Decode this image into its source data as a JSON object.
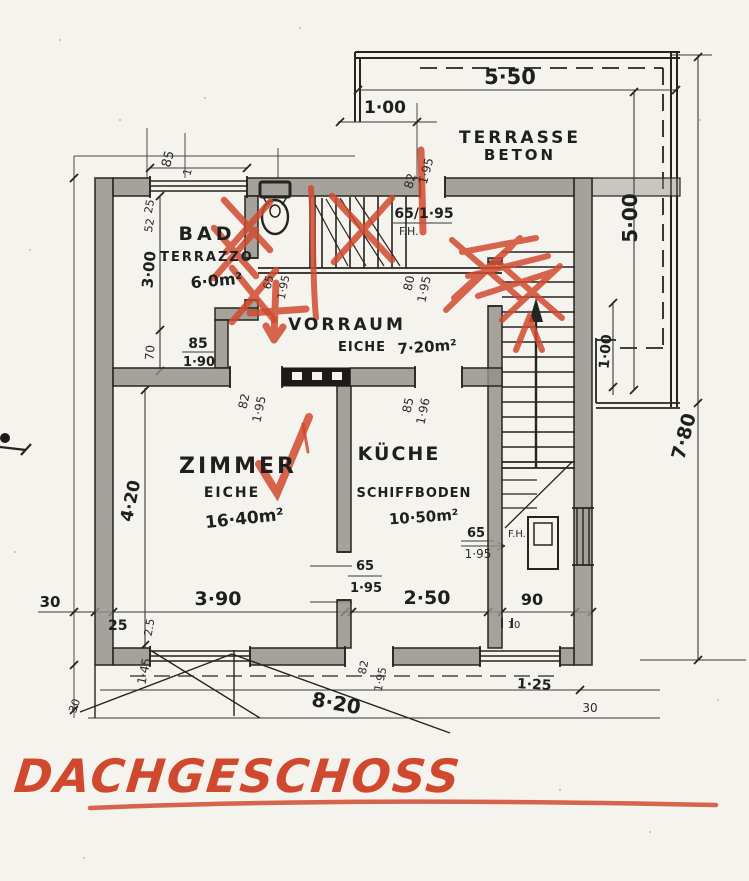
{
  "title": "DACHGESCHOSS",
  "terrace": {
    "line1": "TERRASSE",
    "line2": "BETON"
  },
  "rooms": {
    "bad": {
      "name": "BAD",
      "finish": "TERRAZZO",
      "area": "6·0m²"
    },
    "vorraum": {
      "name": "VORRAUM",
      "finish": "EICHE",
      "area": "7·20m²"
    },
    "zimmer": {
      "name": "ZIMMER",
      "finish": "EICHE",
      "area": "16·40m²"
    },
    "kueche": {
      "name": "KÜCHE",
      "finish": "SCHIFFBODEN",
      "area": "10·50m²"
    }
  },
  "dims": {
    "top_100": "1·00",
    "top_550": "5·50",
    "right_500": "5·00",
    "right_780": "7·80",
    "terrace_100": "1·00",
    "top_door_w": "82",
    "top_door_h": "1·95",
    "bad_win_w": "85",
    "bad_win_x": "1",
    "left_25": "25",
    "left_52": "52",
    "left_300": "3·00",
    "left_70": "70",
    "bad_door_w": "85",
    "bad_door_h": "1·90",
    "wc_door_w": "65",
    "wc_door_h": "1·95",
    "stair_door": "65/1·95",
    "stair_door_fh": "F.H.",
    "stair_right_door_w": "80",
    "stair_right_door_h": "1·95",
    "vorraum_door_w": "82",
    "vorraum_door_h": "1·95",
    "vorraum_right_door_w": "85",
    "vorraum_right_door_h": "1·96",
    "left_420": "4·20",
    "kueche_door_w": "65",
    "kueche_door_h": "1·95",
    "kueche_win_w": "65",
    "kueche_win_fh": "F.H.",
    "kueche_win_h": "1·95",
    "bottom_390": "3·90",
    "bottom_250": "2·50",
    "bottom_90": "90",
    "bottom_10": "10",
    "left_30": "30",
    "left_wall_25": "25",
    "left_wall_25b": "2.5",
    "bottom_win_h": "1·45",
    "bottom_door_w": "82",
    "bottom_door_h": "1·95",
    "bottom_820": "8·20",
    "bottom_125": "1·25",
    "bottom_30": "30",
    "corner_30": "30"
  }
}
